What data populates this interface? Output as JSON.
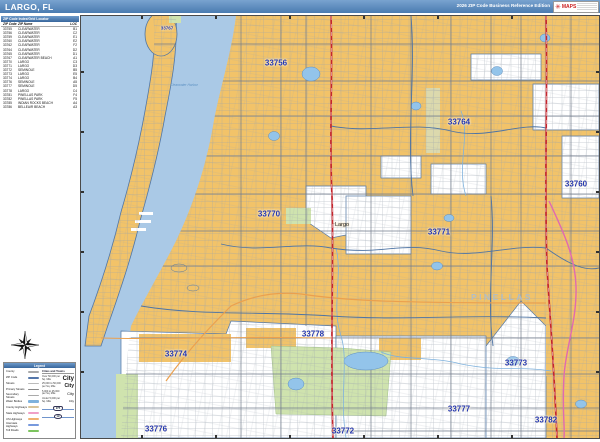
{
  "header": {
    "title": "LARGO, FL",
    "edition": "2026 ZIP Code Business Reference Edition",
    "logo": {
      "brand": "MAPS",
      "burst": "✳"
    }
  },
  "zip_index": {
    "title": "ZIP Code Index/Grid Locator",
    "columns": {
      "zip": "ZIP Code",
      "name": "ZIP Name",
      "loc": "LOC"
    },
    "rows": [
      {
        "zip": "33755",
        "name": "CLEARWATER",
        "loc": "B1"
      },
      {
        "zip": "33756",
        "name": "CLEARWATER",
        "loc": "C2"
      },
      {
        "zip": "33759",
        "name": "CLEARWATER",
        "loc": "E1"
      },
      {
        "zip": "33760",
        "name": "CLEARWATER",
        "loc": "E2"
      },
      {
        "zip": "33762",
        "name": "CLEARWATER",
        "loc": "F2"
      },
      {
        "zip": "33764",
        "name": "CLEARWATER",
        "loc": "D2"
      },
      {
        "zip": "33765",
        "name": "CLEARWATER",
        "loc": "D1"
      },
      {
        "zip": "33767",
        "name": "CLEARWATER BEACH",
        "loc": "A1"
      },
      {
        "zip": "33770",
        "name": "LARGO",
        "loc": "C3"
      },
      {
        "zip": "33771",
        "name": "LARGO",
        "loc": "D3"
      },
      {
        "zip": "33772",
        "name": "SEMINOLE",
        "loc": "B5"
      },
      {
        "zip": "33773",
        "name": "LARGO",
        "loc": "E5"
      },
      {
        "zip": "33774",
        "name": "LARGO",
        "loc": "B4"
      },
      {
        "zip": "33776",
        "name": "SEMINOLE",
        "loc": "A5"
      },
      {
        "zip": "33777",
        "name": "SEMINOLE",
        "loc": "D5"
      },
      {
        "zip": "33778",
        "name": "LARGO",
        "loc": "C4"
      },
      {
        "zip": "33781",
        "name": "PINELLAS PARK",
        "loc": "F4"
      },
      {
        "zip": "33782",
        "name": "PINELLAS PARK",
        "loc": "F5"
      },
      {
        "zip": "33785",
        "name": "INDIAN ROCKS BEACH",
        "loc": "A4"
      },
      {
        "zip": "33786",
        "name": "BELLEAIR BEACH",
        "loc": "A3"
      }
    ]
  },
  "legend": {
    "title": "Legend",
    "line_items": [
      {
        "label": "County"
      },
      {
        "label": "ZIP Code"
      },
      {
        "label": "Streets"
      },
      {
        "label": "Primary Streets"
      },
      {
        "label": "Secondary Streets"
      },
      {
        "label": "Water Bodies"
      },
      {
        "label": "County Highways"
      },
      {
        "label": "State Highways"
      },
      {
        "label": "US Highways"
      },
      {
        "label": "Interstate Highways"
      },
      {
        "label": "Toll Roads"
      }
    ],
    "cities": {
      "title": "Cities and Towns",
      "classes": [
        {
          "range": "Over 50,000 per Sq. Mile",
          "sample": "City"
        },
        {
          "range": "25,000 to 50,000 per Sq. Mile",
          "sample": "City"
        },
        {
          "range": "5,000 to 25,000 per Sq. Mile",
          "sample": "City"
        },
        {
          "range": "Under 5,000 per Sq. Mile",
          "sample": "City"
        }
      ]
    },
    "shields": [
      {
        "label": "Interstate Highway",
        "number": "275"
      },
      {
        "label": "U.S. Highway",
        "number": "19"
      }
    ]
  },
  "map": {
    "zip_labels": [
      {
        "zip": "33767"
      },
      {
        "zip": "33756"
      },
      {
        "zip": "33764"
      },
      {
        "zip": "33760"
      },
      {
        "zip": "33770"
      },
      {
        "zip": "33771"
      },
      {
        "zip": "33778"
      },
      {
        "zip": "33774"
      },
      {
        "zip": "33773"
      },
      {
        "zip": "33777"
      },
      {
        "zip": "33776"
      },
      {
        "zip": "33772"
      },
      {
        "zip": "33782"
      }
    ],
    "city_labels": [
      {
        "name": "Largo"
      }
    ],
    "area_labels": [
      {
        "name": "PINELLAS"
      }
    ],
    "water_labels": [
      {
        "name": "Clearwater Harbor"
      }
    ]
  },
  "colors": {
    "header_blue": "#4a7bb0",
    "zip_fill_tan": "#f2c369",
    "water_blue": "#aac9e6",
    "park_green": "#cfe3ae",
    "zip_label_blue": "#2336b0",
    "zip_boundary": "#4e74a4",
    "highway_red": "#c4262e",
    "highway_pink": "#e06ab0",
    "highway_orange": "#eba04e",
    "toll_green": "#7cc45e"
  }
}
